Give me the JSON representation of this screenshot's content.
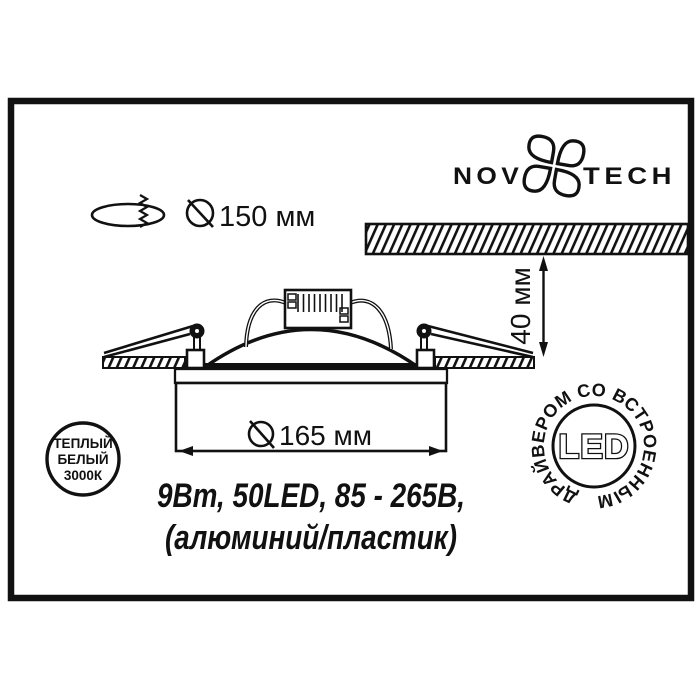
{
  "colors": {
    "ink": "#111111",
    "background": "#ffffff"
  },
  "logo": {
    "left": "NOVO",
    "right": "TECH"
  },
  "cutout": {
    "label": "150 мм"
  },
  "depth": {
    "label": "40 мм"
  },
  "diameter": {
    "label": "165 мм"
  },
  "specs": {
    "line1": "9Вт, 50LED, 85 - 265В,",
    "line2": "(алюминий/пластик)"
  },
  "badge_temp": {
    "line1": "ТЕПЛЫЙ",
    "line2": "БЕЛЫЙ",
    "line3": "3000К"
  },
  "badge_led": {
    "ring": "ДРАЙВЕРОМ СО ВСТРОЕННЫМ",
    "center": "LED"
  }
}
